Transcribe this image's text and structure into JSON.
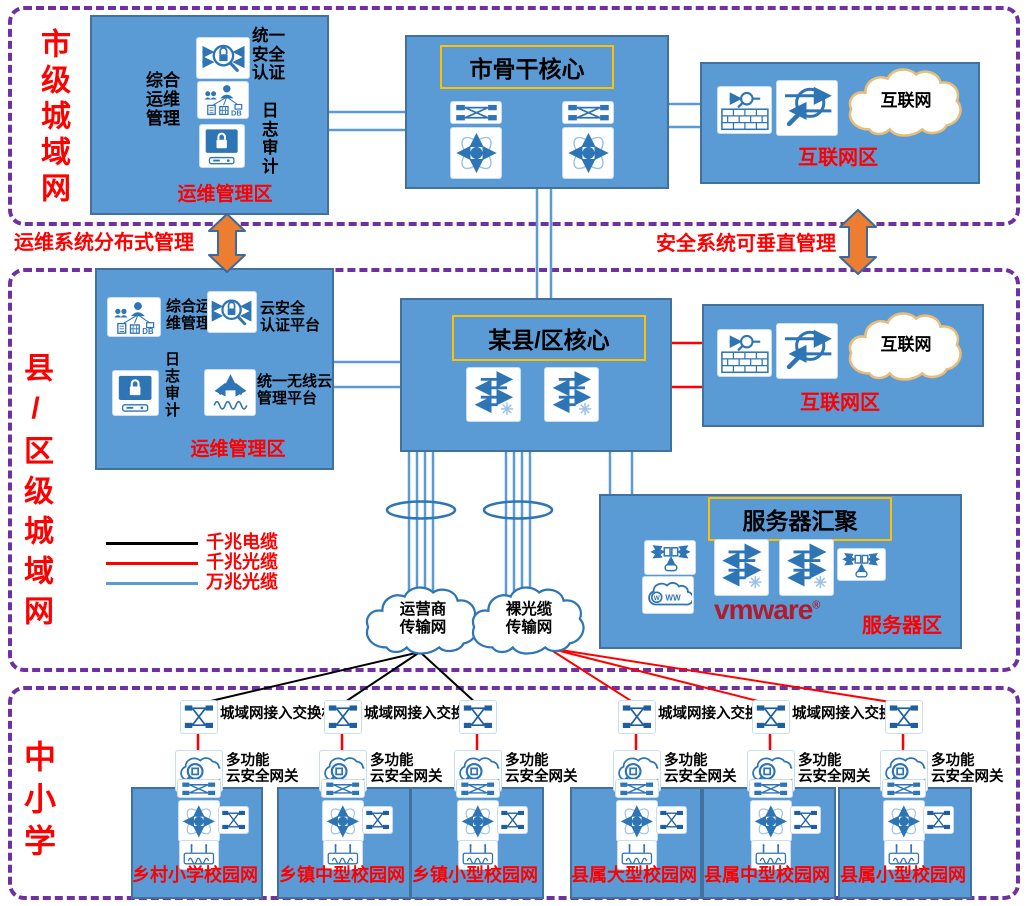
{
  "colors": {
    "box_blue": "#5b9bd5",
    "box_border": "#41719c",
    "icon_blue": "#2e75b6",
    "section_purple": "#7030a0",
    "red": "#ff0000",
    "title_border": "#ffc000",
    "arrow_orange": "#ed7d31",
    "cloud_tan": "#e9bd79",
    "vmware_red": "#b01c2e"
  },
  "city": {
    "section_label": "市级城域网",
    "ops": {
      "zone_label": "运维管理区",
      "mgmt_label": "综合\n运维\n管理",
      "auth_label": "统一\n安全\n认证",
      "log_label": "日\n志\n审\n计"
    },
    "core": {
      "title": "市骨干核心"
    },
    "internet": {
      "zone_label": "互联网区",
      "cloud_label": "互联网"
    }
  },
  "divider": {
    "left_label": "运维系统分布式管理",
    "right_label": "安全系统可垂直管理"
  },
  "county": {
    "section_label": "县/区级城域网",
    "ops": {
      "zone_label": "运维管理区",
      "mgmt_label": "综合运\n维管理",
      "cloud_auth_label": "云安全\n认证平台",
      "log_label": "日\n志\n审\n计",
      "wireless_label": "统一无线云\n管理平台"
    },
    "core": {
      "title": "某县/区核心"
    },
    "internet": {
      "zone_label": "互联网区",
      "cloud_label": "互联网"
    },
    "server": {
      "title": "服务器汇聚",
      "zone_label": "服务器区",
      "vmware_label": "vmware",
      "vmware_reg": "®"
    },
    "legend": [
      {
        "label": "千兆电缆",
        "color": "#000000"
      },
      {
        "label": "千兆光缆",
        "color": "#ff0000"
      },
      {
        "label": "万兆光缆",
        "color": "#5b9bd5"
      }
    ],
    "clouds": {
      "carrier": "运营商\n传输网",
      "bare_fiber": "裸光缆\n传输网"
    }
  },
  "schools": {
    "section_label": "中小学",
    "access_switch_label": "城域网接入交换机",
    "gateway_label": "多功能\n云安全网关",
    "campuses": [
      "乡村小学校园网",
      "乡镇中型校园网",
      "乡镇小型校园网",
      "县属大型校园网",
      "县属中型校园网",
      "县属小型校园网"
    ]
  }
}
